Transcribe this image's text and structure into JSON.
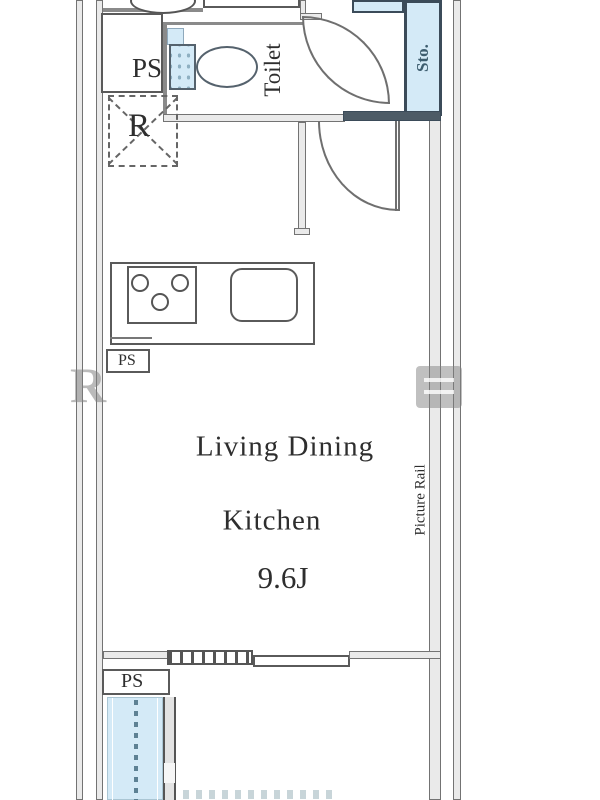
{
  "labels": {
    "living_dining": "Living Dining",
    "kitchen": "Kitchen",
    "area": "9.6J",
    "toilet": "Toilet",
    "storage": "Sto.",
    "refrigerator": "R",
    "ps_top": "PS",
    "ps_mid": "PS",
    "ps_bottom": "PS",
    "picture_rail": "Picture Rail"
  },
  "watermark": {
    "left_letter": "R"
  },
  "colors": {
    "wall_line": "#6f6f6f",
    "wall_fill": "#eaeaea",
    "wall_dark": "#4d5b66",
    "fixture_blue": "#d4eaf7",
    "storage_text": "#3d5d6f",
    "label_text": "#2e2e2e",
    "watermark_gray": "#a3a3a3"
  }
}
